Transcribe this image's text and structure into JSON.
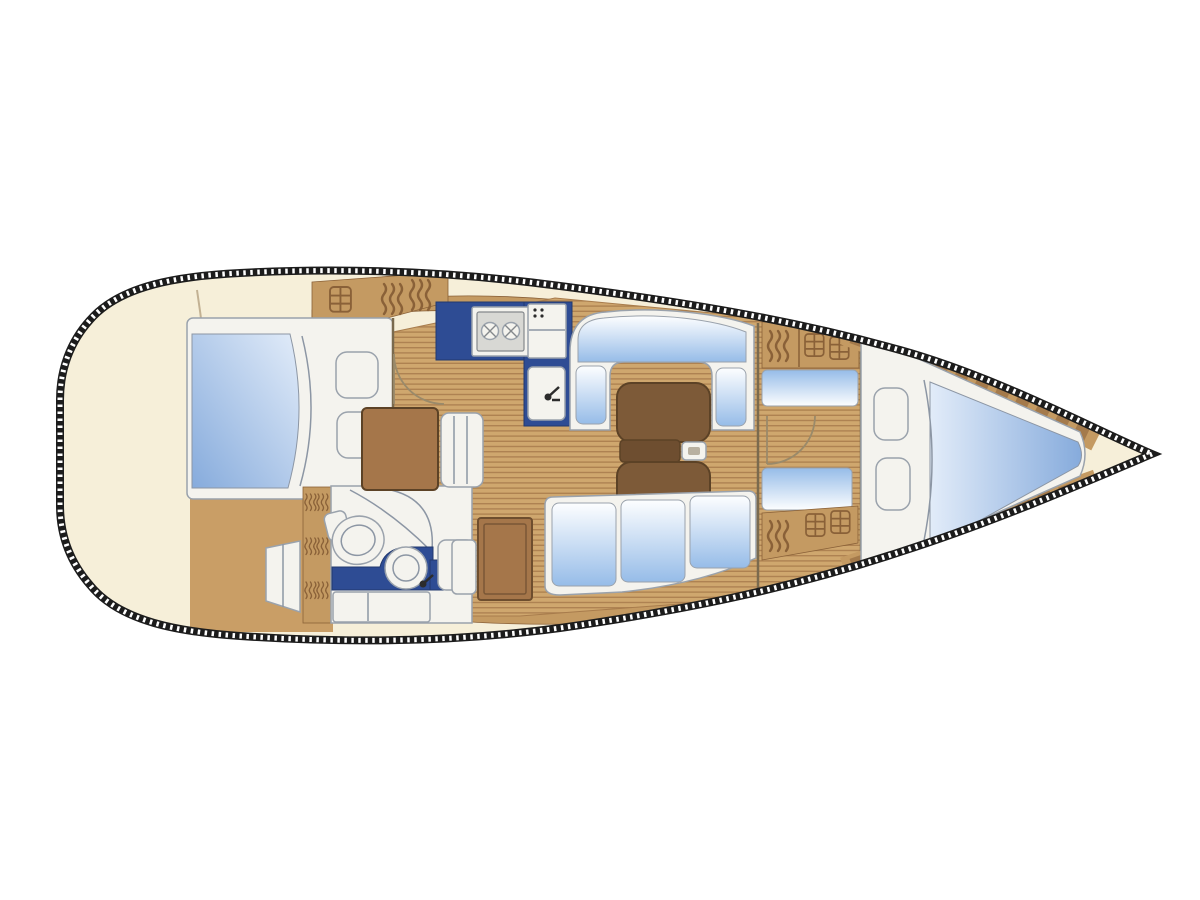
{
  "meta": {
    "title": "Sailing yacht interior layout plan",
    "diagram_type": "boat floor plan, top-down view",
    "orientation": {
      "bow": "right",
      "stern": "left"
    }
  },
  "palette": {
    "hull_fill": "#f6efd9",
    "hull_border": "#1c1c1c",
    "rope_light": "#ffffff",
    "deck_wood": "#c49a62",
    "deck_wood_dark": "#8a6138",
    "teak_light": "#cfa76e",
    "teak_dark": "#a87c4c",
    "aft_floor": "#c99e66",
    "cabinet_wood": "#a5764a",
    "cabinet_dark": "#6e4e2e",
    "table_wood": "#7d5a38",
    "table_mid": "#6e4e30",
    "table_dark": "#5c4226",
    "counter_navy": "#2e4c94",
    "cushion_white": "#fdfeff",
    "cushion_blue": "#96bce8",
    "bed_blue_deep": "#86abdc",
    "bed_blue_light": "#e2ecf9",
    "fixture_white": "#f4f3ee",
    "fixture_border": "#9aa2ac",
    "outline": "#8c96a4",
    "wall_brown": "#7a6a4e",
    "door_line": "#9a8a6a",
    "transom": "#c2b193",
    "steel": "#d8d8d4"
  },
  "rooms": {
    "stern_deck": {
      "label": "Stern deck and transom area"
    },
    "aft_cabin": {
      "label": "Aft double cabin with athwartships berth"
    },
    "head": {
      "label": "Head compartment with toilet, washbasin and shower"
    },
    "nav_station": {
      "label": "Navigation station with chart table and seat"
    },
    "galley": {
      "label": "Galley with two-burner stove, refrigerator and sink"
    },
    "salon": {
      "label": "Salon with U-shaped settee, folding table and straight settee"
    },
    "corridor": {
      "label": "Passageway with stowage lockers to forward cabin"
    },
    "forward_cabin": {
      "label": "Forward cabin with V-berth"
    },
    "bow": {
      "label": "Bow with anchor locker area"
    }
  },
  "fixtures": {
    "aft_berth": {
      "label": "Aft double berth with blanket and two pillows"
    },
    "hanging_locker": {
      "label": "Hanging locker with louvered door"
    },
    "companionway_steps": {
      "label": "Companionway steps"
    },
    "toilet": {
      "label": "Marine toilet"
    },
    "vanity_sink": {
      "label": "Washbasin on navy vanity counter"
    },
    "shower_curtain": {
      "label": "Shower curtain track"
    },
    "stove": {
      "label": "Two-burner stove"
    },
    "refrigerator": {
      "label": "Refrigerator / worktop"
    },
    "galley_sink": {
      "label": "Galley sink with faucet"
    },
    "chart_table": {
      "label": "Chart table"
    },
    "nav_seat": {
      "label": "Navigator seat"
    },
    "salon_table": {
      "label": "Folding salon table with bottle holder"
    },
    "u_settee": {
      "label": "U-shaped settee"
    },
    "straight_settee": {
      "label": "Straight settee, three cushions"
    },
    "storage_cabinet": {
      "label": "Storage cabinet"
    },
    "locker_vents": {
      "label": "Louvered locker doors"
    },
    "locker_doors": {
      "label": "Caned locker doors"
    },
    "v_berth": {
      "label": "V-berth with blanket and two pillows"
    },
    "door_aft": {
      "label": "Aft cabin door swing"
    },
    "door_forward": {
      "label": "Forward cabin door swing"
    }
  }
}
